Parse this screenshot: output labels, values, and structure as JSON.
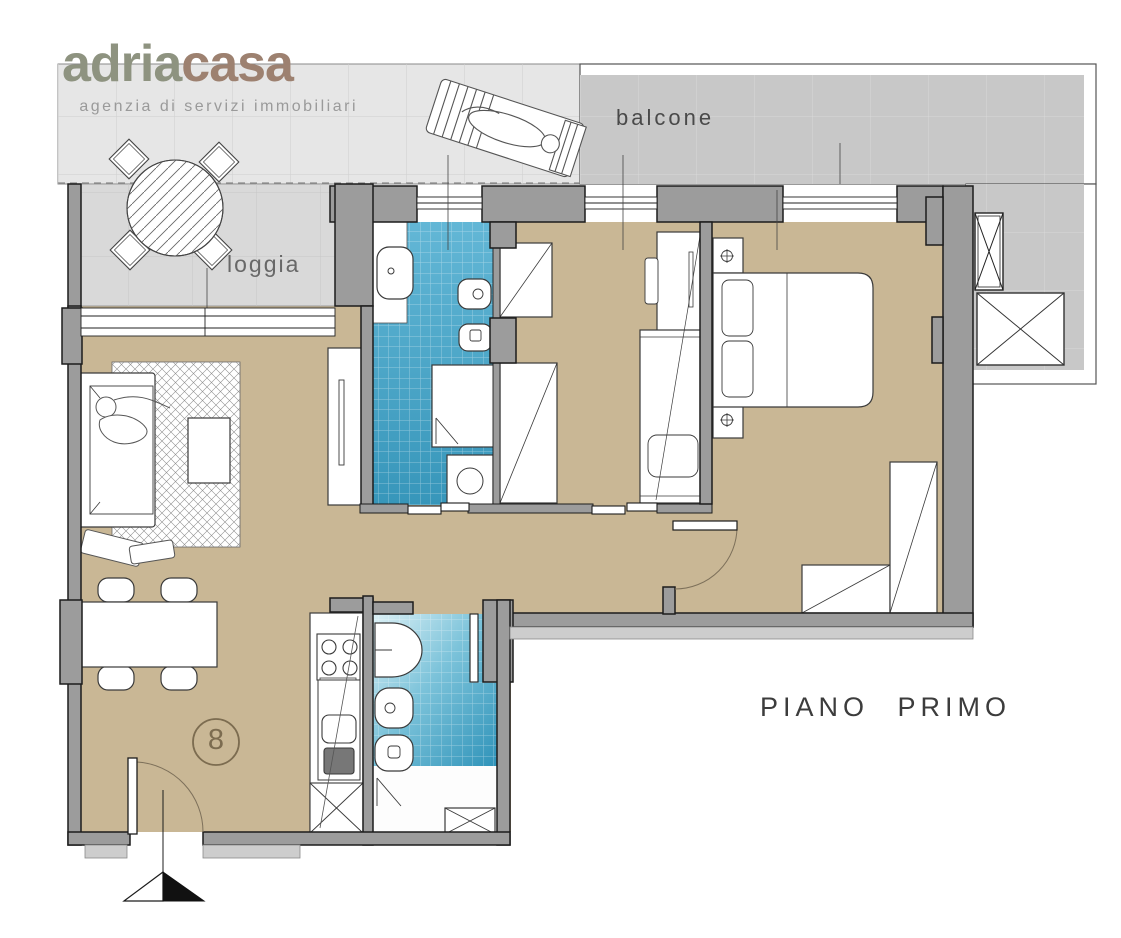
{
  "logo": {
    "name_part_1": "adria",
    "name_part_2": "casa",
    "tagline": "agenzia di servizi immobiliari",
    "color_part_1": "#8e9380",
    "color_part_2": "#9d8170"
  },
  "plan": {
    "labels": {
      "balcony": "balcone",
      "loggia": "loggia",
      "floor_title": "PIANO PRIMO",
      "unit_number": "8"
    },
    "colors": {
      "interior_floor": "#c9b795",
      "wall": "#9c9c9c",
      "bathroom_tile": "#45a5c8",
      "balcony_tile_dark": "#c8c8c8",
      "balcony_tile_light": "#e6e6e6",
      "loggia_tile": "#d9d9d9",
      "label_text": "#3c3c3c"
    }
  }
}
